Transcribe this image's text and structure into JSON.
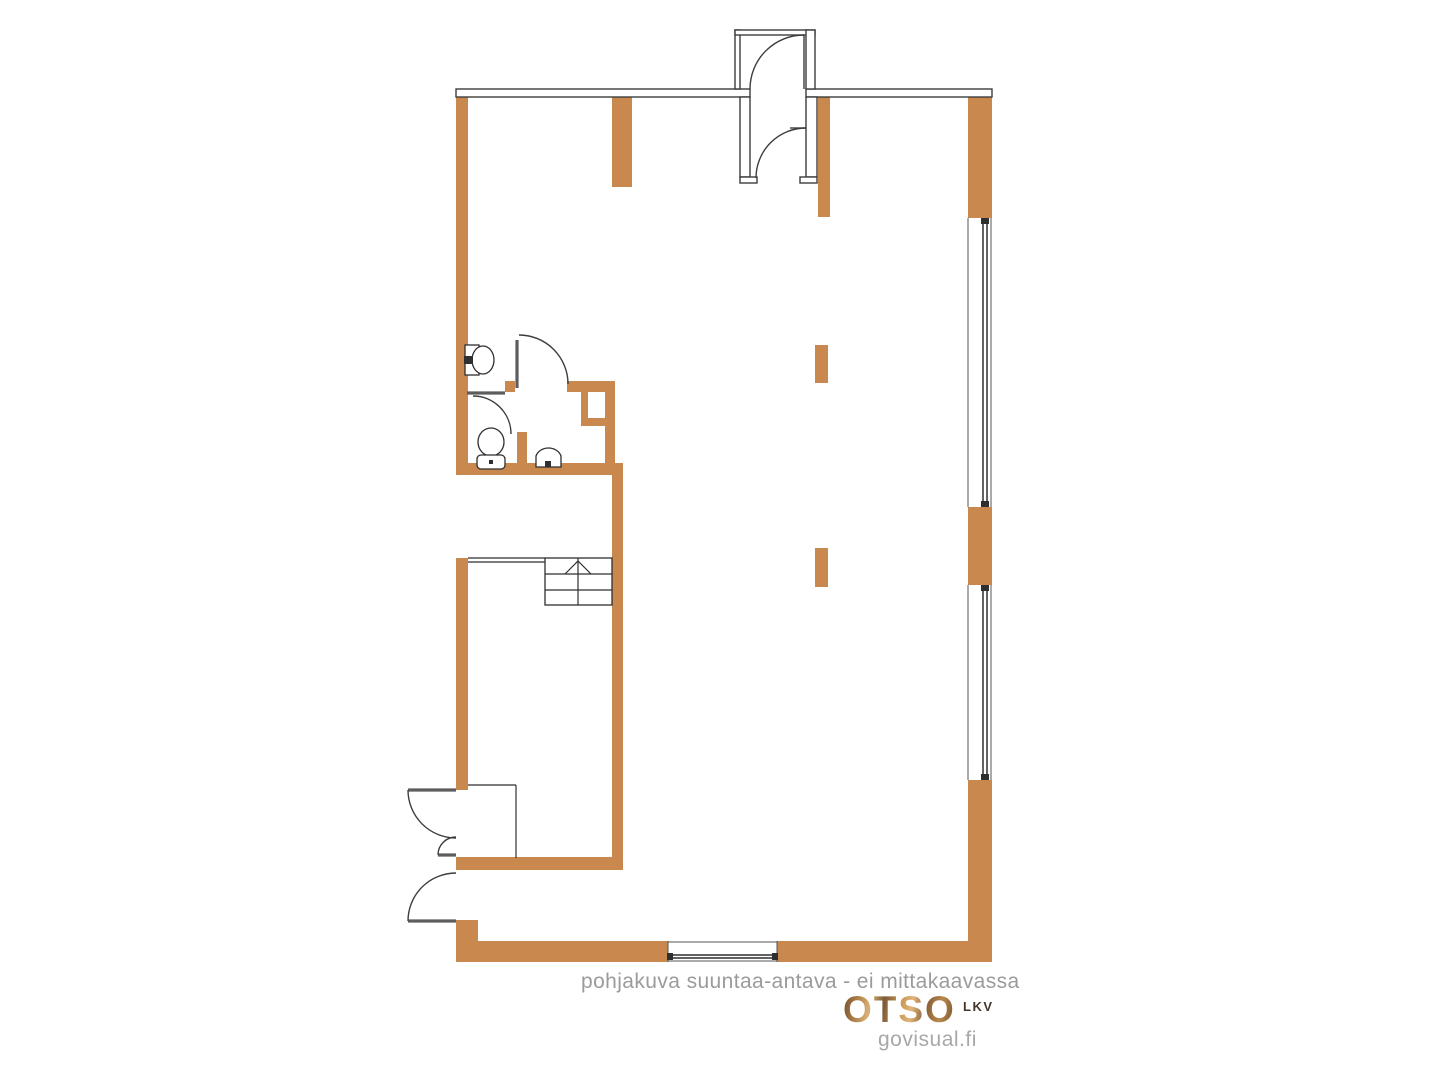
{
  "canvas": {
    "width": 1440,
    "height": 1080,
    "background": "#ffffff"
  },
  "footer": {
    "disclaimer": "pohjakuva suuntaa-antava - ei mittakaavassa",
    "brand": "OTSO",
    "brand_suffix": "LKV",
    "credit": "govisual.fi"
  },
  "palette": {
    "wall_orange": "#C8884E",
    "outline_dark": "#3d3d3d",
    "leaf_gray": "#5d5d5d",
    "text_gray": "#9b9b9b",
    "logo_brown": "#9c6b3f"
  },
  "floorplan": {
    "styles": {
      "wall": {
        "fill": "#C8884E"
      },
      "outwall": {
        "fill": "#ffffff",
        "stroke": "#3d3d3d",
        "sw": 1.4
      },
      "door": {
        "fill": "none",
        "stroke": "#3d3d3d",
        "sw": 1.4
      },
      "thin": {
        "fill": "none",
        "stroke": "#2f2f2f",
        "sw": 1.2
      },
      "thinfill": {
        "fill": "#ffffff",
        "stroke": "#2f2f2f",
        "sw": 1.3
      },
      "leaf": {
        "fill": "none",
        "stroke": "#5d5d5d",
        "sw": 3.2
      },
      "glaze": {
        "fill": "none",
        "stroke": "#2f2f2f",
        "sw": 1.5
      },
      "face": {
        "fill": "none",
        "stroke": "#555555",
        "sw": 1
      },
      "dark": {
        "fill": "#2f2f2f"
      }
    },
    "shapes": [
      {
        "t": "rect",
        "n": "left-wall-upper",
        "s": "wall",
        "x": 456,
        "y": 97,
        "w": 12,
        "h": 378
      },
      {
        "t": "path",
        "n": "left-wall-mitre",
        "s": "wall",
        "d": "M456,89 L468,97 L456,97 Z"
      },
      {
        "t": "rect",
        "n": "top-interior-stub-left",
        "s": "wall",
        "x": 612,
        "y": 97,
        "w": 20,
        "h": 90
      },
      {
        "t": "rect",
        "n": "top-interior-stub-right",
        "s": "wall",
        "x": 818,
        "y": 97,
        "w": 12,
        "h": 120
      },
      {
        "t": "rect",
        "n": "right-wall-top",
        "s": "wall",
        "x": 968,
        "y": 97,
        "w": 24,
        "h": 121
      },
      {
        "t": "rect",
        "n": "right-wall-pier",
        "s": "wall",
        "x": 968,
        "y": 507,
        "w": 24,
        "h": 78
      },
      {
        "t": "rect",
        "n": "right-wall-bottom",
        "s": "wall",
        "x": 968,
        "y": 780,
        "w": 24,
        "h": 182
      },
      {
        "t": "rect",
        "n": "column-pier-a",
        "s": "wall",
        "x": 815,
        "y": 345,
        "w": 13,
        "h": 38
      },
      {
        "t": "rect",
        "n": "column-pier-b",
        "s": "wall",
        "x": 815,
        "y": 548,
        "w": 13,
        "h": 39
      },
      {
        "t": "rect",
        "n": "bath-top-wall-mid",
        "s": "wall",
        "x": 505,
        "y": 381,
        "w": 10,
        "h": 11
      },
      {
        "t": "rect",
        "n": "bath-top-wall-right",
        "s": "wall",
        "x": 567,
        "y": 381,
        "w": 48,
        "h": 11
      },
      {
        "t": "rect",
        "n": "duct-niche-stub",
        "s": "wall",
        "x": 581,
        "y": 392,
        "w": 7,
        "h": 26
      },
      {
        "t": "rect",
        "n": "duct-niche-bottom",
        "s": "wall",
        "x": 581,
        "y": 418,
        "w": 34,
        "h": 8
      },
      {
        "t": "rect",
        "n": "bath-right-wall",
        "s": "wall",
        "x": 605,
        "y": 392,
        "w": 10,
        "h": 83
      },
      {
        "t": "rect",
        "n": "bath-bottom-wall",
        "s": "wall",
        "x": 456,
        "y": 463,
        "w": 159,
        "h": 12
      },
      {
        "t": "rect",
        "n": "wc-partition",
        "s": "wall",
        "x": 517,
        "y": 432,
        "w": 10,
        "h": 43
      },
      {
        "t": "rect",
        "n": "lower-room-right-wall",
        "s": "wall",
        "x": 612,
        "y": 463,
        "w": 11,
        "h": 407
      },
      {
        "t": "rect",
        "n": "lower-left-wall",
        "s": "wall",
        "x": 456,
        "y": 558,
        "w": 12,
        "h": 232
      },
      {
        "t": "rect",
        "n": "mid-horizontal-wall",
        "s": "wall",
        "x": 456,
        "y": 857,
        "w": 167,
        "h": 13
      },
      {
        "t": "rect",
        "n": "entry-corner-stub",
        "s": "wall",
        "x": 456,
        "y": 920,
        "w": 22,
        "h": 42
      },
      {
        "t": "rect",
        "n": "bottom-wall-left",
        "s": "wall",
        "x": 456,
        "y": 941,
        "w": 212,
        "h": 21
      },
      {
        "t": "rect",
        "n": "bottom-wall-right",
        "s": "wall",
        "x": 777,
        "y": 941,
        "w": 215,
        "h": 21
      },
      {
        "t": "rect",
        "n": "top-wall-left-segment",
        "s": "outwall",
        "x": 456,
        "y": 89,
        "w": 294,
        "h": 8
      },
      {
        "t": "rect",
        "n": "top-wall-right-segment",
        "s": "outwall",
        "x": 806,
        "y": 89,
        "w": 186,
        "h": 8
      },
      {
        "t": "rect",
        "n": "vestibule-left-wall",
        "s": "outwall",
        "x": 735,
        "y": 30,
        "w": 5,
        "h": 59
      },
      {
        "t": "rect",
        "n": "vestibule-top-wall",
        "s": "outwall",
        "x": 735,
        "y": 30,
        "w": 80,
        "h": 5
      },
      {
        "t": "rect",
        "n": "vestibule-right-wall",
        "s": "outwall",
        "x": 806,
        "y": 30,
        "w": 9,
        "h": 59
      },
      {
        "t": "rect",
        "n": "door-jamb-left",
        "s": "outwall",
        "x": 740,
        "y": 97,
        "w": 10,
        "h": 80
      },
      {
        "t": "rect",
        "n": "door-jamb-left-foot",
        "s": "outwall",
        "x": 740,
        "y": 177,
        "w": 17,
        "h": 6
      },
      {
        "t": "rect",
        "n": "door-jamb-right",
        "s": "outwall",
        "x": 806,
        "y": 97,
        "w": 11,
        "h": 80
      },
      {
        "t": "rect",
        "n": "door-jamb-right-foot",
        "s": "outwall",
        "x": 800,
        "y": 177,
        "w": 17,
        "h": 6
      },
      {
        "t": "line",
        "n": "vestibule-door-leaf",
        "s": "door",
        "x1": 804,
        "y1": 35,
        "x2": 804,
        "y2": 89
      },
      {
        "t": "path",
        "n": "vestibule-door-arc",
        "s": "door",
        "d": "M 804 35 A 54 54 0 0 0 750 89"
      },
      {
        "t": "line",
        "n": "inner-door-leaf",
        "s": "door",
        "x1": 790,
        "y1": 128,
        "x2": 806,
        "y2": 128
      },
      {
        "t": "path",
        "n": "inner-door-arc",
        "s": "door",
        "d": "M 806 128 A 50 50 0 0 0 756 178"
      },
      {
        "t": "line",
        "n": "bath-door-leaf",
        "s": "leaf",
        "x1": 517,
        "y1": 340,
        "x2": 517,
        "y2": 388
      },
      {
        "t": "path",
        "n": "bath-door-arc",
        "s": "door",
        "d": "M 519 335 A 49 49 0 0 1 568 384"
      },
      {
        "t": "line",
        "n": "wc-door-leaf",
        "s": "leaf",
        "x1": 467,
        "y1": 393,
        "x2": 505,
        "y2": 393
      },
      {
        "t": "path",
        "n": "wc-door-arc",
        "s": "door",
        "d": "M 473 396 A 38 38 0 0 1 511 434"
      },
      {
        "t": "line",
        "n": "entry-door-a-leaf",
        "s": "leaf",
        "x1": 408,
        "y1": 790,
        "x2": 456,
        "y2": 790
      },
      {
        "t": "path",
        "n": "entry-door-a-arc",
        "s": "door",
        "d": "M 408 790 A 48 48 0 0 0 456 838"
      },
      {
        "t": "line",
        "n": "entry-door-a2-leaf",
        "s": "leaf",
        "x1": 438,
        "y1": 855,
        "x2": 456,
        "y2": 855
      },
      {
        "t": "path",
        "n": "entry-door-a2-arc",
        "s": "door",
        "d": "M 438 855 A 18 18 0 0 1 456 837"
      },
      {
        "t": "line",
        "n": "entry-door-b-leaf",
        "s": "leaf",
        "x1": 408,
        "y1": 921,
        "x2": 456,
        "y2": 921
      },
      {
        "t": "path",
        "n": "entry-door-b-arc",
        "s": "door",
        "d": "M 408 921 A 48 48 0 0 1 456 873"
      },
      {
        "t": "line",
        "n": "closet-top-line",
        "s": "thin",
        "x1": 468,
        "y1": 785,
        "x2": 516,
        "y2": 785
      },
      {
        "t": "line",
        "n": "closet-right-line",
        "s": "thin",
        "x1": 516,
        "y1": 785,
        "x2": 516,
        "y2": 858
      },
      {
        "t": "line",
        "n": "railing-line-1",
        "s": "thin",
        "x1": 468,
        "y1": 558,
        "x2": 545,
        "y2": 558
      },
      {
        "t": "line",
        "n": "railing-line-2",
        "s": "thin",
        "x1": 468,
        "y1": 562,
        "x2": 545,
        "y2": 562
      },
      {
        "t": "rect",
        "n": "stairs-outline",
        "s": "thinfill",
        "x": 545,
        "y": 558,
        "w": 67,
        "h": 47
      },
      {
        "t": "line",
        "n": "stairs-tread-1",
        "s": "thin",
        "x1": 545,
        "y1": 574,
        "x2": 612,
        "y2": 574
      },
      {
        "t": "line",
        "n": "stairs-tread-2",
        "s": "thin",
        "x1": 545,
        "y1": 590,
        "x2": 612,
        "y2": 590
      },
      {
        "t": "line",
        "n": "stairs-center-line",
        "s": "thin",
        "x1": 578,
        "y1": 558,
        "x2": 578,
        "y2": 605
      },
      {
        "t": "polyline",
        "n": "stairs-up-arrow",
        "s": "thin",
        "pts": "565,574 578,561 591,574"
      },
      {
        "t": "line",
        "n": "bottom-window-jamb-left",
        "s": "face",
        "x1": 668,
        "y1": 941,
        "x2": 668,
        "y2": 962
      },
      {
        "t": "line",
        "n": "bottom-window-jamb-right",
        "s": "face",
        "x1": 777,
        "y1": 941,
        "x2": 777,
        "y2": 962
      },
      {
        "t": "line",
        "n": "bottom-window-outer-face",
        "s": "face",
        "x1": 668,
        "y1": 942,
        "x2": 777,
        "y2": 942
      },
      {
        "t": "line",
        "n": "bottom-window-inner-face",
        "s": "face",
        "x1": 668,
        "y1": 961,
        "x2": 777,
        "y2": 961
      },
      {
        "t": "line",
        "n": "bottom-window-glazing-1",
        "s": "glaze",
        "x1": 672,
        "y1": 955,
        "x2": 773,
        "y2": 955
      },
      {
        "t": "line",
        "n": "bottom-window-glazing-2",
        "s": "glaze",
        "x1": 672,
        "y1": 958,
        "x2": 773,
        "y2": 958
      },
      {
        "t": "rect",
        "n": "bottom-window-end-left",
        "s": "dark",
        "x": 667,
        "y": 953,
        "w": 6,
        "h": 7
      },
      {
        "t": "rect",
        "n": "bottom-window-end-right",
        "s": "dark",
        "x": 772,
        "y": 953,
        "w": 6,
        "h": 7
      },
      {
        "t": "line",
        "n": "right-window-1-inner-face",
        "s": "face",
        "x1": 968,
        "y1": 218,
        "x2": 968,
        "y2": 507
      },
      {
        "t": "line",
        "n": "right-window-1-outer-face",
        "s": "face",
        "x1": 991,
        "y1": 218,
        "x2": 991,
        "y2": 507
      },
      {
        "t": "line",
        "n": "right-window-1-glazing-1",
        "s": "glaze",
        "x1": 983,
        "y1": 220,
        "x2": 983,
        "y2": 505
      },
      {
        "t": "line",
        "n": "right-window-1-glazing-2",
        "s": "glaze",
        "x1": 987,
        "y1": 220,
        "x2": 987,
        "y2": 505
      },
      {
        "t": "rect",
        "n": "right-window-1-end-top",
        "s": "dark",
        "x": 981,
        "y": 218,
        "w": 8,
        "h": 6
      },
      {
        "t": "rect",
        "n": "right-window-1-end-bottom",
        "s": "dark",
        "x": 981,
        "y": 501,
        "w": 8,
        "h": 6
      },
      {
        "t": "line",
        "n": "right-window-2-inner-face",
        "s": "face",
        "x1": 968,
        "y1": 585,
        "x2": 968,
        "y2": 780
      },
      {
        "t": "line",
        "n": "right-window-2-outer-face",
        "s": "face",
        "x1": 991,
        "y1": 585,
        "x2": 991,
        "y2": 780
      },
      {
        "t": "line",
        "n": "right-window-2-glazing-1",
        "s": "glaze",
        "x1": 983,
        "y1": 587,
        "x2": 983,
        "y2": 778
      },
      {
        "t": "line",
        "n": "right-window-2-glazing-2",
        "s": "glaze",
        "x1": 987,
        "y1": 587,
        "x2": 987,
        "y2": 778
      },
      {
        "t": "rect",
        "n": "right-window-2-end-top",
        "s": "dark",
        "x": 981,
        "y": 585,
        "w": 8,
        "h": 6
      },
      {
        "t": "rect",
        "n": "right-window-2-end-bottom",
        "s": "dark",
        "x": 981,
        "y": 774,
        "w": 8,
        "h": 6
      },
      {
        "t": "rect",
        "n": "washbasin-base",
        "s": "thinfill",
        "x": 465,
        "y": 345,
        "w": 14,
        "h": 30
      },
      {
        "t": "ellipse",
        "n": "washbasin-bowl",
        "s": "thinfill",
        "cx": 483,
        "cy": 360,
        "rx": 11,
        "ry": 14
      },
      {
        "t": "rect",
        "n": "washbasin-tap",
        "s": "dark",
        "x": 464,
        "y": 356,
        "w": 9,
        "h": 8
      },
      {
        "t": "ellipse",
        "n": "toilet-bowl",
        "s": "thinfill",
        "cx": 491,
        "cy": 442,
        "rx": 13,
        "ry": 14
      },
      {
        "t": "rect",
        "n": "toilet-tank",
        "s": "thinfill",
        "x": 477,
        "y": 455,
        "w": 28,
        "h": 14,
        "rx": 4
      },
      {
        "t": "rect",
        "n": "toilet-button",
        "s": "dark",
        "x": 489,
        "y": 460,
        "w": 4,
        "h": 4
      },
      {
        "t": "path",
        "n": "utility-sink-bowl",
        "s": "thinfill",
        "d": "M 536 467 L 536 456 A 13 11 0 0 1 561 456 L 561 467 Z"
      },
      {
        "t": "rect",
        "n": "utility-sink-tap",
        "s": "dark",
        "x": 545,
        "y": 461,
        "w": 6,
        "h": 6
      }
    ]
  }
}
